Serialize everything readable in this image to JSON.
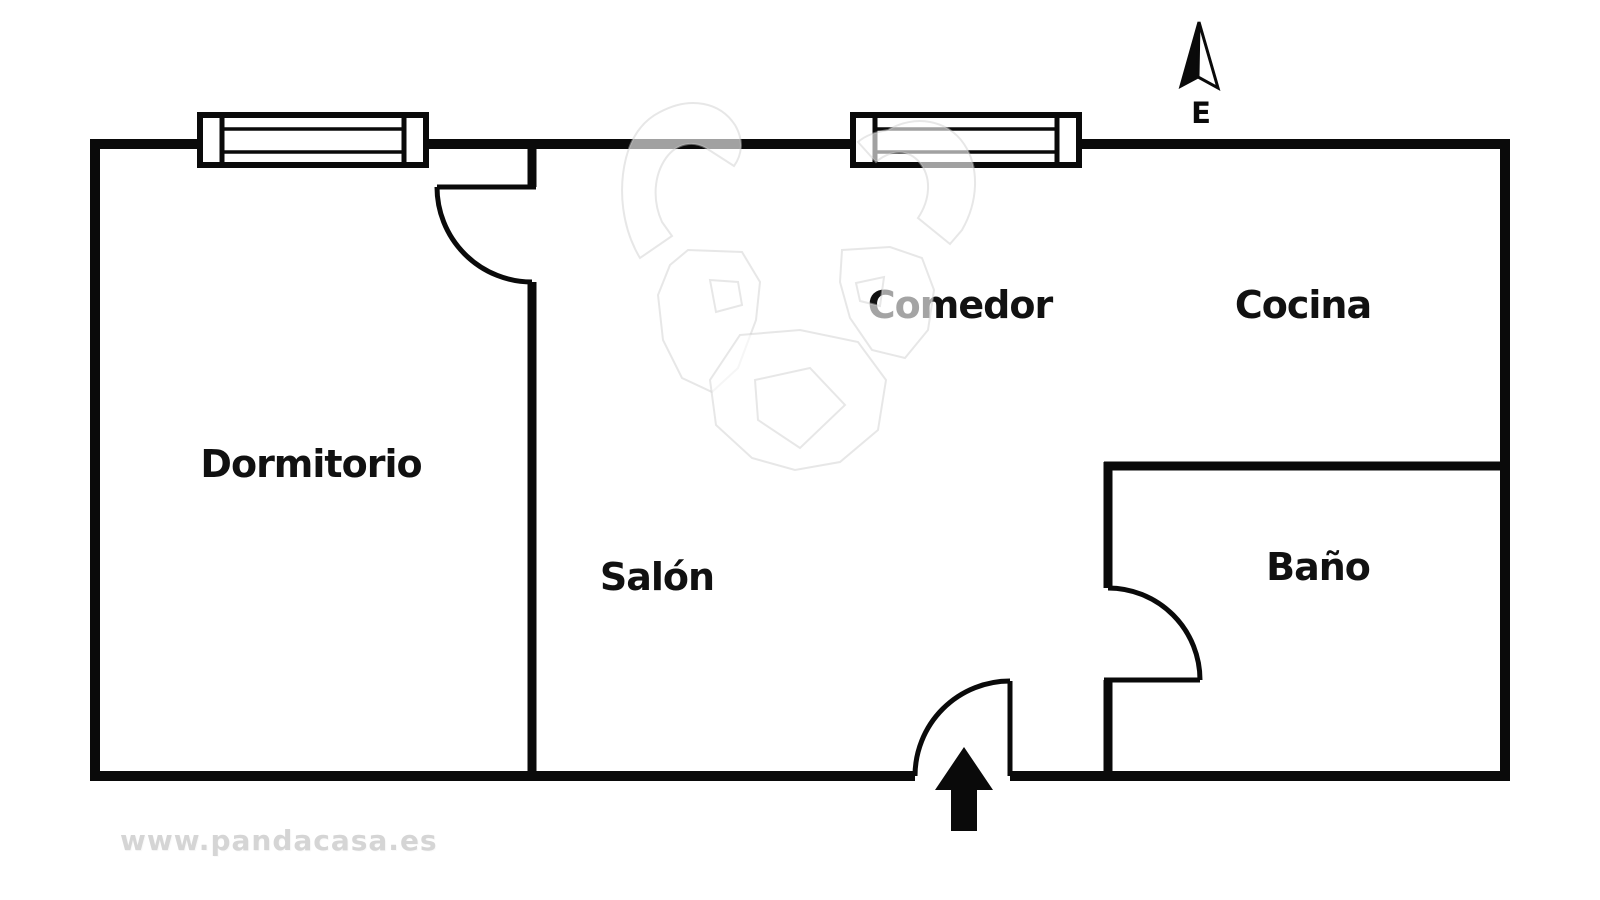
{
  "page": {
    "background_color": "#ffffff",
    "line_color": "#0a0a0a",
    "text_color": "#111111"
  },
  "floor_plan": {
    "rooms": [
      {
        "name": "dormitorio",
        "label": "Dormitorio"
      },
      {
        "name": "salon",
        "label": "Salón"
      },
      {
        "name": "comedor",
        "label": "Comedor"
      },
      {
        "name": "cocina",
        "label": "Cocina"
      },
      {
        "name": "bano",
        "label": "Baño"
      }
    ],
    "compass": {
      "direction_label": "E"
    },
    "windows": [
      {
        "name": "window-dormitorio"
      },
      {
        "name": "window-comedor"
      }
    ],
    "doors": [
      {
        "name": "door-dormitorio"
      },
      {
        "name": "door-bano"
      },
      {
        "name": "door-entrance"
      }
    ],
    "entrance_arrow": {
      "name": "entrance-arrow",
      "direction": "up"
    }
  },
  "watermark": {
    "site_text": "www.pandacasa.es",
    "text_color": "#d5d5d5",
    "logo_name": "panda-logo"
  }
}
